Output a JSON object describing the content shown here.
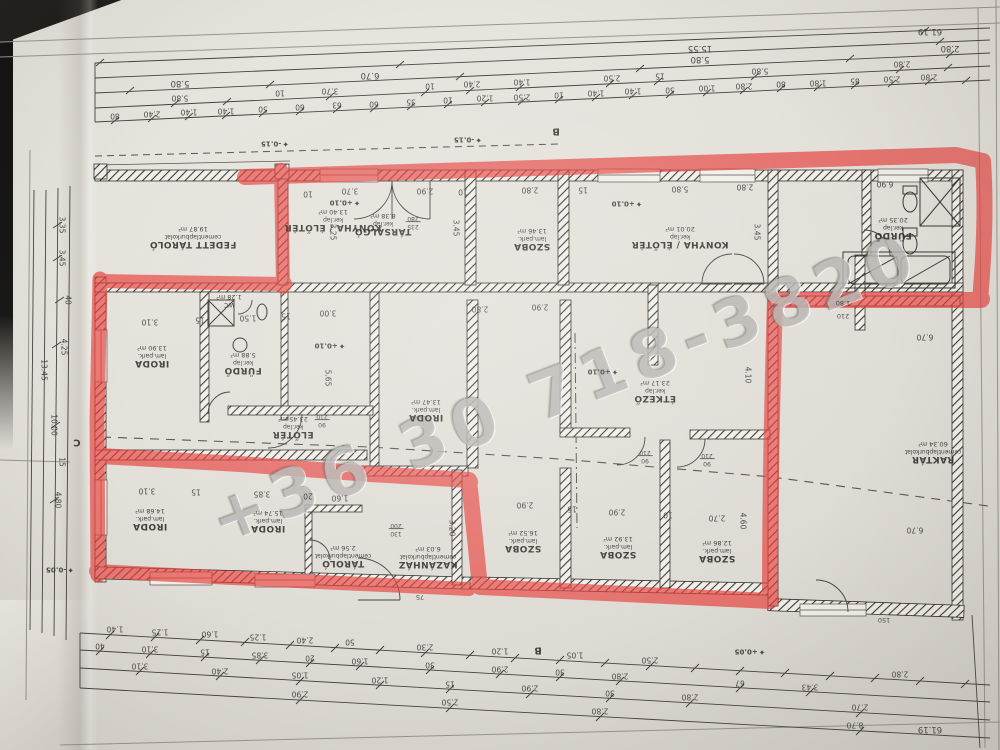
{
  "watermark": {
    "text": "+36 30 718-3820"
  },
  "colors": {
    "marker_red": "#e8403c",
    "paper": "#e6e2db",
    "ink": "#3a3834"
  },
  "icons": {
    "level_marker": "✦"
  },
  "sections": {
    "b_top": "B",
    "b_bottom": "B",
    "c_left": "C"
  },
  "levels": {
    "minus015_a": "-0.15",
    "minus015_b": "-0.15",
    "plus010_a": "+0.10",
    "plus010_b": "+0.10",
    "plus010_c": "+0.10",
    "plus010_d": "+0.10",
    "plus005": "+0.05",
    "minus005": "-0.05"
  },
  "rooms": {
    "fedett": {
      "name": "FEDETT TÁROLÓ",
      "finish": "cementlapburkolat",
      "area": "19.87 m²"
    },
    "konyha_left": {
      "name": "KONYHA / ÉLŐTÉR",
      "finish": "ker.lap",
      "area": "13.40 m²"
    },
    "tarsalgo": {
      "name": "TÁRSALGÓ",
      "finish": "ker.lap",
      "area": "8.38 m²"
    },
    "szoba_top": {
      "name": "SZOBA",
      "finish": "lam.park.",
      "area": "13.46 m²"
    },
    "konyha_right": {
      "name": "KONYHA / ÉLŐTÉR",
      "finish": "ker.lap",
      "area": "20.01 m²"
    },
    "furdo_tr": {
      "name": "FÜRDŐ",
      "finish": "ker.lap",
      "area": "20.35 m²"
    },
    "iroda_ml": {
      "name": "IRODA",
      "finish": "lam.park.",
      "area": "13.90 m²"
    },
    "furdo_m": {
      "name": "FÜRDŐ",
      "finish": "ker.lap",
      "area": "5.88 m²"
    },
    "wc": {
      "name": "WC",
      "finish": "",
      "area": "1.28 m²"
    },
    "eloter": {
      "name": "ELŐTÉR",
      "finish": "ker.lap",
      "area": "23.45 m²"
    },
    "iroda_c": {
      "name": "IRODA",
      "finish": "lam.park.",
      "area": "13.47 m²"
    },
    "etkezo": {
      "name": "ÉTKEZŐ",
      "finish": "ker.lap",
      "area": "23.17 m²"
    },
    "raktar": {
      "name": "RAKTÁR",
      "finish": "cementlapburkolat",
      "area": "60.34 m²"
    },
    "iroda_b1": {
      "name": "IRODA",
      "finish": "lam.park.",
      "area": "14.68 m²"
    },
    "iroda_b2": {
      "name": "IRODA",
      "finish": "lam.park.",
      "area": "15.74 m²"
    },
    "tarolo": {
      "name": "TÁROLÓ",
      "finish": "cementlapburkolat",
      "area": "2.56 m²"
    },
    "kazanhaz": {
      "name": "KAZÁNHÁZ",
      "finish": "cementlapburkolat",
      "area": "6.03 m²"
    },
    "szoba_b1": {
      "name": "SZOBA",
      "finish": "lam.park.",
      "area": "16.52 m²"
    },
    "szoba_b2": {
      "name": "SZOBA",
      "finish": "lam.park.",
      "area": "13.92 m²"
    },
    "szoba_b3": {
      "name": "SZOBA",
      "finish": "lam.park.",
      "area": "12.86 m²"
    }
  },
  "dims": {
    "top1": [
      "61.19"
    ],
    "top2": [
      "15.55"
    ],
    "top3": [
      "5.80",
      "6.70",
      "5.80",
      "2.80"
    ],
    "top4": [
      "5.80",
      "10",
      "3.70",
      "10",
      "2.40",
      "1.40",
      "2.50",
      "15",
      "5.80",
      "2.80"
    ],
    "top5": [
      "80",
      "2.40",
      "1.40",
      "1.40",
      "50",
      "60",
      "63",
      "60",
      "35",
      "10",
      "1.20",
      "2.50",
      "10",
      "1.40",
      "1.40",
      "50",
      "1.00",
      "2.80",
      "80",
      "1.80",
      "85",
      "2.50",
      "2.80"
    ],
    "bottom1": [
      "1.40",
      "1.25",
      "1.60",
      "1.25",
      "2.40",
      "50",
      "2.30",
      "1.20",
      "1.05",
      "2.50",
      "2.80"
    ],
    "bottom2": [
      "40",
      "3.10",
      "15",
      "3.85",
      "20",
      "1.60",
      "30",
      "2.90",
      "30",
      "2.80",
      "67",
      "3.43"
    ],
    "bottom3": [
      "3.10",
      "2.40",
      "1.05",
      "1.20",
      "15",
      "2.90",
      "30",
      "2.80",
      "2.70"
    ],
    "bottom4": [
      "2.90",
      "2.50",
      "2.80",
      "8.70",
      "61.19"
    ],
    "left": [
      "3.35",
      "3.45",
      "40",
      "4.25",
      "13.45",
      "10.00",
      "15",
      "4.80"
    ],
    "inner_top": [
      "3.70",
      "10",
      "2.90",
      "2.80",
      "15",
      "10",
      "5.80",
      "2.80",
      "6.90"
    ],
    "inner_mid": [
      "3.10",
      "15",
      "1.50",
      "15",
      "3.00",
      "2.80",
      "2.90"
    ],
    "inner_offices": [
      "3.10",
      "15",
      "3.85",
      "20",
      "1.60"
    ],
    "inner_szoba": [
      "2.90",
      "15",
      "2.90",
      "10",
      "2.70"
    ],
    "inner_vertical": [
      "3.25",
      "3.45",
      "3.45",
      "5.65",
      "4.10",
      "3.20",
      "4.60"
    ],
    "raktar": [
      "6.70",
      "6.70"
    ],
    "door_stacks": [
      [
        "90",
        "210"
      ],
      [
        "90",
        "210"
      ],
      [
        "90",
        "210"
      ],
      [
        "130",
        "200"
      ],
      [
        "235",
        "280"
      ]
    ],
    "door_singles": [
      "75",
      "150",
      "210",
      "1.80"
    ]
  }
}
